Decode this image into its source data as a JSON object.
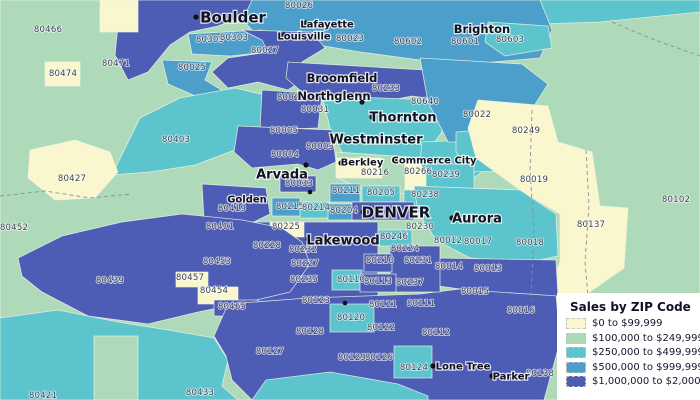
{
  "palette": {
    "class_colors": [
      "#FAF7CE",
      "#AFDABA",
      "#5BC4CD",
      "#4C9FCB",
      "#4D5CB4"
    ],
    "background": "#AFDABA",
    "boundary": "#EEF2E4",
    "dashed_line": "#8A8F98",
    "zip_label_color": "#3A4254",
    "city_label_color": "#121220",
    "halo": "#FFFFFF",
    "dot_color": "#111111"
  },
  "legend": {
    "title": "Sales by ZIP Code",
    "items": [
      {
        "label": "$0 to $99,999",
        "color_class": 1
      },
      {
        "label": "$100,000 to $249,999",
        "color_class": 2
      },
      {
        "label": "$250,000 to $499,999",
        "color_class": 3
      },
      {
        "label": "$500,000 to $999,999",
        "color_class": 4
      },
      {
        "label": "$1,000,000 to $2,000,000",
        "color_class": 5
      }
    ]
  },
  "map": {
    "regions": [
      {
        "id": "base-green",
        "class": 2,
        "points": "0,0 700,0 700,400 0,400"
      },
      {
        "id": "topright-teal",
        "class": 3,
        "points": "535,0 700,0 700,12 600,22 540,24"
      },
      {
        "id": "north-blue-band",
        "class": 4,
        "points": "225,0 540,0 552,30 540,58 470,64 420,60 360,52 300,42 252,30"
      },
      {
        "id": "80603-teal",
        "class": 3,
        "points": "488,22 548,26 552,48 505,56 485,42"
      },
      {
        "id": "boulder-west-indigo",
        "class": 5,
        "points": "128,0 252,0 245,15 218,26 190,32 170,45 148,72 128,80 115,55 118,25"
      },
      {
        "id": "80305-blue",
        "class": 4,
        "points": "188,34 262,30 268,52 230,56 192,54"
      },
      {
        "id": "louisville-indigo",
        "class": 5,
        "points": "242,30 312,32 325,48 302,62 312,74 288,90 258,82 228,88 212,72 228,58 268,52 262,40"
      },
      {
        "id": "80025-blue",
        "class": 4,
        "points": "162,60 212,62 205,80 225,92 200,98 168,84"
      },
      {
        "id": "80403-teal",
        "class": 3,
        "points": "112,175 140,118 180,98 235,88 265,95 268,125 240,148 195,165 150,172"
      },
      {
        "id": "80427-cream",
        "class": 1,
        "points": "30,150 75,140 110,152 118,172 95,198 55,200 28,178"
      },
      {
        "id": "cream-top",
        "class": 1,
        "points": "100,0 138,0 138,32 100,32"
      },
      {
        "id": "80474-cream",
        "class": 1,
        "points": "45,62 80,62 80,86 45,86"
      },
      {
        "id": "broomfield-indigo",
        "class": 5,
        "points": "288,62 425,70 440,100 412,96 372,104 332,99 302,92 286,78"
      },
      {
        "id": "80021-indigo",
        "class": 5,
        "points": "262,90 322,94 318,128 260,130"
      },
      {
        "id": "thornton-teal",
        "class": 3,
        "points": "322,96 438,100 442,132 420,162 372,168 342,152 330,128"
      },
      {
        "id": "arvada-indigo",
        "class": 5,
        "points": "238,126 332,130 336,162 318,170 298,164 252,168 234,152"
      },
      {
        "id": "berkley-green-band",
        "class": 2,
        "points": "336,152 422,158 426,190 398,194 358,188 338,178"
      },
      {
        "id": "berkley-cream",
        "class": 1,
        "points": "336,158 382,158 382,178 336,178"
      },
      {
        "id": "80266-cream",
        "class": 1,
        "points": "405,161 429,161 429,191 405,191"
      },
      {
        "id": "commerce-teal",
        "class": 3,
        "points": "422,142 472,140 482,172 460,188 430,186 420,162"
      },
      {
        "id": "80022-blue",
        "class": 4,
        "points": "420,58 522,64 548,84 524,122 484,142 448,142 428,102"
      },
      {
        "id": "80249-teal",
        "class": 3,
        "points": "456,132 532,126 548,152 540,170 472,172 456,152"
      },
      {
        "id": "80019-80137-cream",
        "class": 1,
        "points": "478,100 548,106 558,142 592,152 600,206 628,208 624,268 584,296 566,330 540,332 545,300 560,262 560,214 520,190 476,158 468,128"
      },
      {
        "id": "80239-teal",
        "class": 3,
        "points": "426,164 474,164 474,190 426,190"
      },
      {
        "id": "80238-teal",
        "class": 3,
        "points": "404,190 444,190 444,208 404,208"
      },
      {
        "id": "80211-blue",
        "class": 4,
        "points": "330,184 360,184 360,202 330,202"
      },
      {
        "id": "80205-teal",
        "class": 3,
        "points": "362,186 400,186 400,202 362,202"
      },
      {
        "id": "80204-blue",
        "class": 4,
        "points": "328,204 356,204 356,220 328,220"
      },
      {
        "id": "80214-teal",
        "class": 3,
        "points": "300,202 328,202 328,218 300,218"
      },
      {
        "id": "80215-blue",
        "class": 4,
        "points": "272,198 300,198 300,216 272,216"
      },
      {
        "id": "80033-indigo",
        "class": 5,
        "points": "280,176 316,176 316,192 280,192"
      },
      {
        "id": "denver-core-indigo",
        "class": 5,
        "points": "352,202 414,202 414,220 352,220"
      },
      {
        "id": "golden-indigo",
        "class": 5,
        "points": "202,184 266,188 270,214 242,228 204,220"
      },
      {
        "id": "lakewood-indigo",
        "class": 5,
        "points": "240,222 378,222 378,308 240,308"
      },
      {
        "id": "80225-cream",
        "class": 1,
        "points": "270,222 304,222 304,237 270,237"
      },
      {
        "id": "southwest-indigo",
        "class": 5,
        "points": "18,258 62,236 122,222 182,214 242,220 282,228 302,242 310,264 290,292 248,302 198,312 148,324 88,316 42,292 22,276"
      },
      {
        "id": "80457-cream",
        "class": 1,
        "points": "176,272 208,272 208,287 176,287"
      },
      {
        "id": "80454-cream",
        "class": 1,
        "points": "198,287 238,287 238,304 198,304"
      },
      {
        "id": "80465-indigo",
        "class": 5,
        "points": "214,300 258,300 258,316 214,316"
      },
      {
        "id": "sw-bottom-teal",
        "class": 3,
        "points": "0,318 58,310 118,322 168,330 214,338 228,360 222,386 238,400 0,400"
      },
      {
        "id": "green-strip",
        "class": 2,
        "points": "94,336 138,336 138,400 94,400"
      },
      {
        "id": "south-central-indigo",
        "class": 5,
        "points": "214,336 228,304 308,298 420,294 468,288 556,294 560,342 544,400 252,400 232,380 226,356"
      },
      {
        "id": "80120-teal",
        "class": 3,
        "points": "330,304 374,304 374,332 330,332"
      },
      {
        "id": "80124-teal",
        "class": 3,
        "points": "394,346 432,346 432,378 394,378"
      },
      {
        "id": "bottom-center-teal",
        "class": 3,
        "points": "252,400 266,380 330,372 398,384 428,396 428,400"
      },
      {
        "id": "aurora-teal",
        "class": 3,
        "points": "414,186 520,190 556,214 558,256 530,262 470,258 436,240 418,212"
      },
      {
        "id": "aurora-south-indigo",
        "class": 5,
        "points": "436,258 556,260 558,296 468,290 438,286"
      },
      {
        "id": "80246-teal",
        "class": 3,
        "points": "378,230 412,230 412,246 378,246"
      },
      {
        "id": "80224-80231-indigo",
        "class": 5,
        "points": "390,246 440,246 440,292 390,292"
      },
      {
        "id": "80210-indigo",
        "class": 5,
        "points": "364,254 392,254 392,272 364,272"
      },
      {
        "id": "80110-teal",
        "class": 3,
        "points": "332,270 362,270 362,290 332,290"
      },
      {
        "id": "80113-indigo",
        "class": 5,
        "points": "360,274 396,274 396,292 360,292"
      }
    ],
    "dashed_lines": [
      {
        "points": "0,196 45,191 90,198 132,194"
      },
      {
        "points": "586,150 589,205 585,262 590,320 587,400"
      },
      {
        "points": "612,22 655,40 700,56"
      },
      {
        "points": "532,110 530,170 534,230 531,300"
      }
    ],
    "zip_labels": [
      {
        "zip": "80466",
        "x": 48,
        "y": 32
      },
      {
        "zip": "80474",
        "x": 63,
        "y": 76
      },
      {
        "zip": "80471",
        "x": 116,
        "y": 66
      },
      {
        "zip": "80305",
        "x": 210,
        "y": 42
      },
      {
        "zip": "80303",
        "x": 234,
        "y": 40
      },
      {
        "zip": "80026",
        "x": 299,
        "y": 8
      },
      {
        "zip": "80025",
        "x": 192,
        "y": 70
      },
      {
        "zip": "80027",
        "x": 265,
        "y": 53
      },
      {
        "zip": "80023",
        "x": 350,
        "y": 41
      },
      {
        "zip": "80602",
        "x": 408,
        "y": 44
      },
      {
        "zip": "80601",
        "x": 465,
        "y": 44
      },
      {
        "zip": "80603",
        "x": 510,
        "y": 42
      },
      {
        "zip": "80233",
        "x": 386,
        "y": 91
      },
      {
        "zip": "80640",
        "x": 425,
        "y": 104
      },
      {
        "zip": "80021",
        "x": 291,
        "y": 100
      },
      {
        "zip": "80031",
        "x": 315,
        "y": 112
      },
      {
        "zip": "80005",
        "x": 284,
        "y": 133
      },
      {
        "zip": "80003",
        "x": 320,
        "y": 149
      },
      {
        "zip": "80004",
        "x": 285,
        "y": 157
      },
      {
        "zip": "80022",
        "x": 477,
        "y": 117
      },
      {
        "zip": "80249",
        "x": 526,
        "y": 133
      },
      {
        "zip": "80019",
        "x": 534,
        "y": 182
      },
      {
        "zip": "80102",
        "x": 676,
        "y": 202
      },
      {
        "zip": "80137",
        "x": 591,
        "y": 227
      },
      {
        "zip": "80403",
        "x": 176,
        "y": 142
      },
      {
        "zip": "80427",
        "x": 72,
        "y": 181
      },
      {
        "zip": "80452",
        "x": 14,
        "y": 230
      },
      {
        "zip": "80401",
        "x": 220,
        "y": 229
      },
      {
        "zip": "80419",
        "x": 232,
        "y": 211
      },
      {
        "zip": "80216",
        "x": 375,
        "y": 175
      },
      {
        "zip": "80266",
        "x": 418,
        "y": 174
      },
      {
        "zip": "80239",
        "x": 446,
        "y": 177
      },
      {
        "zip": "80211",
        "x": 346,
        "y": 193
      },
      {
        "zip": "80205",
        "x": 381,
        "y": 195
      },
      {
        "zip": "80238",
        "x": 425,
        "y": 197
      },
      {
        "zip": "80215",
        "x": 290,
        "y": 209
      },
      {
        "zip": "80214",
        "x": 316,
        "y": 210
      },
      {
        "zip": "80204",
        "x": 344,
        "y": 213
      },
      {
        "zip": "80033",
        "x": 299,
        "y": 186
      },
      {
        "zip": "80230",
        "x": 420,
        "y": 229
      },
      {
        "zip": "80246",
        "x": 394,
        "y": 239
      },
      {
        "zip": "80224",
        "x": 405,
        "y": 251
      },
      {
        "zip": "80231",
        "x": 418,
        "y": 263
      },
      {
        "zip": "80210",
        "x": 380,
        "y": 263
      },
      {
        "zip": "80237",
        "x": 410,
        "y": 285
      },
      {
        "zip": "80113",
        "x": 378,
        "y": 284
      },
      {
        "zip": "80110",
        "x": 351,
        "y": 282
      },
      {
        "zip": "80225",
        "x": 286,
        "y": 229
      },
      {
        "zip": "80228",
        "x": 267,
        "y": 248
      },
      {
        "zip": "80232",
        "x": 303,
        "y": 252
      },
      {
        "zip": "80227",
        "x": 305,
        "y": 266
      },
      {
        "zip": "80235",
        "x": 304,
        "y": 282
      },
      {
        "zip": "80123",
        "x": 316,
        "y": 303
      },
      {
        "zip": "80121",
        "x": 383,
        "y": 307
      },
      {
        "zip": "80120",
        "x": 351,
        "y": 320
      },
      {
        "zip": "80122",
        "x": 381,
        "y": 330
      },
      {
        "zip": "80111",
        "x": 421,
        "y": 306
      },
      {
        "zip": "80112",
        "x": 436,
        "y": 335
      },
      {
        "zip": "80124",
        "x": 414,
        "y": 370
      },
      {
        "zip": "80126",
        "x": 379,
        "y": 360
      },
      {
        "zip": "80129",
        "x": 352,
        "y": 360
      },
      {
        "zip": "80128",
        "x": 310,
        "y": 334
      },
      {
        "zip": "80127",
        "x": 270,
        "y": 354
      },
      {
        "zip": "80012",
        "x": 448,
        "y": 243
      },
      {
        "zip": "80017",
        "x": 478,
        "y": 244
      },
      {
        "zip": "80018",
        "x": 530,
        "y": 245
      },
      {
        "zip": "80014",
        "x": 449,
        "y": 269
      },
      {
        "zip": "80013",
        "x": 488,
        "y": 271
      },
      {
        "zip": "80015",
        "x": 475,
        "y": 294
      },
      {
        "zip": "80016",
        "x": 521,
        "y": 313
      },
      {
        "zip": "80138",
        "x": 540,
        "y": 376
      },
      {
        "zip": "80439",
        "x": 110,
        "y": 283
      },
      {
        "zip": "80453",
        "x": 217,
        "y": 264
      },
      {
        "zip": "80457",
        "x": 190,
        "y": 280
      },
      {
        "zip": "80454",
        "x": 214,
        "y": 293
      },
      {
        "zip": "80465",
        "x": 232,
        "y": 309
      },
      {
        "zip": "80433",
        "x": 200,
        "y": 395
      },
      {
        "zip": "80421",
        "x": 43,
        "y": 398
      }
    ],
    "cities": [
      {
        "name": "Boulder",
        "x": 233,
        "y": 17,
        "dot_x": 196,
        "dot_y": 17,
        "size": "xl"
      },
      {
        "name": "Lafayette",
        "x": 327,
        "y": 24,
        "dot_x": 306,
        "dot_y": 23,
        "size": "sm"
      },
      {
        "name": "Louisville",
        "x": 304,
        "y": 36,
        "dot_x": 284,
        "dot_y": 35,
        "size": "sm"
      },
      {
        "name": "Brighton",
        "x": 482,
        "y": 29,
        "dot_x": 457,
        "dot_y": 29,
        "size": "md"
      },
      {
        "name": "Broomfield",
        "x": 342,
        "y": 78,
        "dot_x": 309,
        "dot_y": 77,
        "size": "md"
      },
      {
        "name": "Northglenn",
        "x": 334,
        "y": 96,
        "dot_x": 362,
        "dot_y": 102,
        "size": "md"
      },
      {
        "name": "Thornton",
        "x": 403,
        "y": 117,
        "dot_x": 372,
        "dot_y": 117,
        "size": "lg"
      },
      {
        "name": "Westminster",
        "x": 376,
        "y": 139,
        "dot_x": 334,
        "dot_y": 139,
        "size": "lg"
      },
      {
        "name": "Berkley",
        "x": 362,
        "y": 162,
        "dot_x": 341,
        "dot_y": 163,
        "size": "sm"
      },
      {
        "name": "Commerce City",
        "x": 434,
        "y": 160,
        "dot_x": 395,
        "dot_y": 160,
        "size": "sm"
      },
      {
        "name": "Arvada",
        "x": 282,
        "y": 174,
        "dot_x": 306,
        "dot_y": 165,
        "size": "lg"
      },
      {
        "name": "Golden",
        "x": 247,
        "y": 199,
        "size": "sm"
      },
      {
        "name": "DENVER",
        "x": 396,
        "y": 212,
        "dot_x": 363,
        "dot_y": 212,
        "size": "xl"
      },
      {
        "name": "Aurora",
        "x": 477,
        "y": 218,
        "dot_x": 452,
        "dot_y": 218,
        "size": "lg"
      },
      {
        "name": "Lakewood",
        "x": 343,
        "y": 240,
        "dot_x": 308,
        "dot_y": 239,
        "size": "lg"
      },
      {
        "name": "Lone Tree",
        "x": 463,
        "y": 366,
        "dot_x": 433,
        "dot_y": 366,
        "size": "sm"
      },
      {
        "name": "Parker",
        "x": 511,
        "y": 376,
        "dot_x": 492,
        "dot_y": 376,
        "size": "sm"
      }
    ],
    "dots": [
      {
        "x": 362,
        "y": 102
      },
      {
        "x": 310,
        "y": 192
      },
      {
        "x": 345,
        "y": 303
      }
    ]
  }
}
